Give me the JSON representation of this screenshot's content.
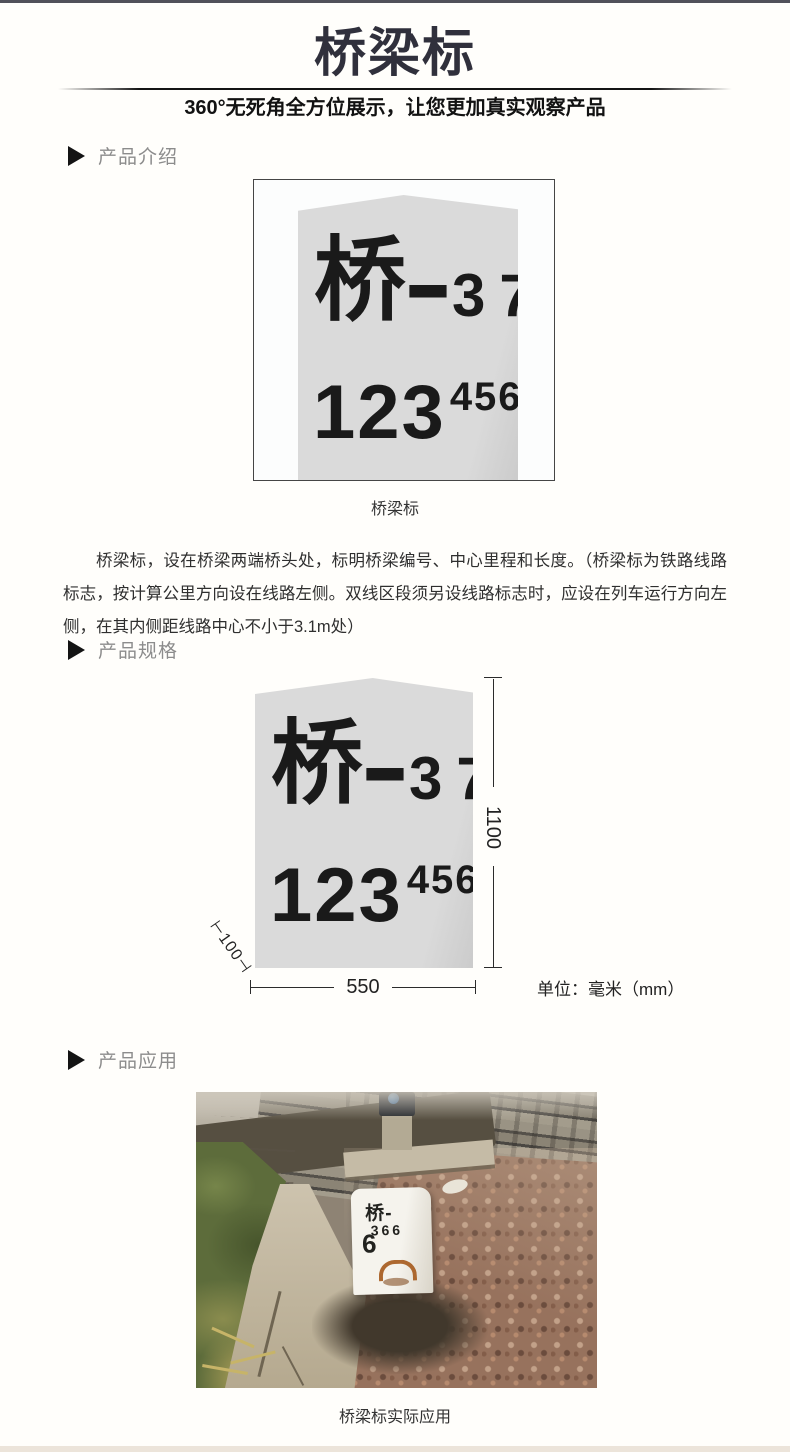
{
  "header": {
    "title": "桥梁标",
    "subtitle": "360°无死角全方位展示，让您更加真实观察产品"
  },
  "sections": {
    "intro_label": "产品介绍",
    "spec_label": "产品规格",
    "app_label": "产品应用"
  },
  "marker_face": {
    "char": "桥",
    "dash": "—",
    "serial": "37",
    "mileage_main": "123",
    "mileage_sup": "456"
  },
  "intro": {
    "caption": "桥梁标",
    "description": "桥梁标，设在桥梁两端桥头处，标明桥梁编号、中心里程和长度。（桥梁标为铁路线路标志，按计算公里方向设在线路左侧。双线区段须另设线路标志时，应设在列车运行方向左侧，在其内侧距线路中心不小于3.1m处）"
  },
  "spec": {
    "height_mm": "1100",
    "width_mm": "550",
    "depth_mm": "⊢100⊣",
    "unit": "单位：毫米（mm）"
  },
  "application": {
    "stone_line1": "桥-",
    "stone_big": "6",
    "stone_small": "366",
    "caption": "桥梁标实际应用"
  },
  "colors": {
    "title": "#30303c",
    "section_label": "#8c8c8c",
    "stone_gray": "#d9d9d9",
    "body_text": "#2f2f2f",
    "rust": "#a65a1c"
  }
}
